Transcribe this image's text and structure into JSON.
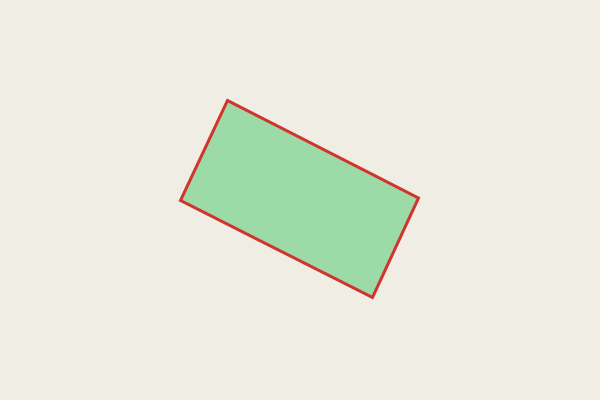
{
  "canvas": {
    "width": 600,
    "height": 400,
    "background_color": "#f0ede5",
    "shape": {
      "kind": "rotated-rectangle",
      "type": "polygon",
      "vertices": [
        [
          227.5,
          100.5
        ],
        [
          418.5,
          198.0
        ],
        [
          372.5,
          297.5
        ],
        [
          180.5,
          200.5
        ]
      ],
      "fill_color": "#9cdaa8",
      "stroke_color": "#d0342c",
      "stroke_width": 3,
      "stroke_linejoin": "miter"
    }
  }
}
